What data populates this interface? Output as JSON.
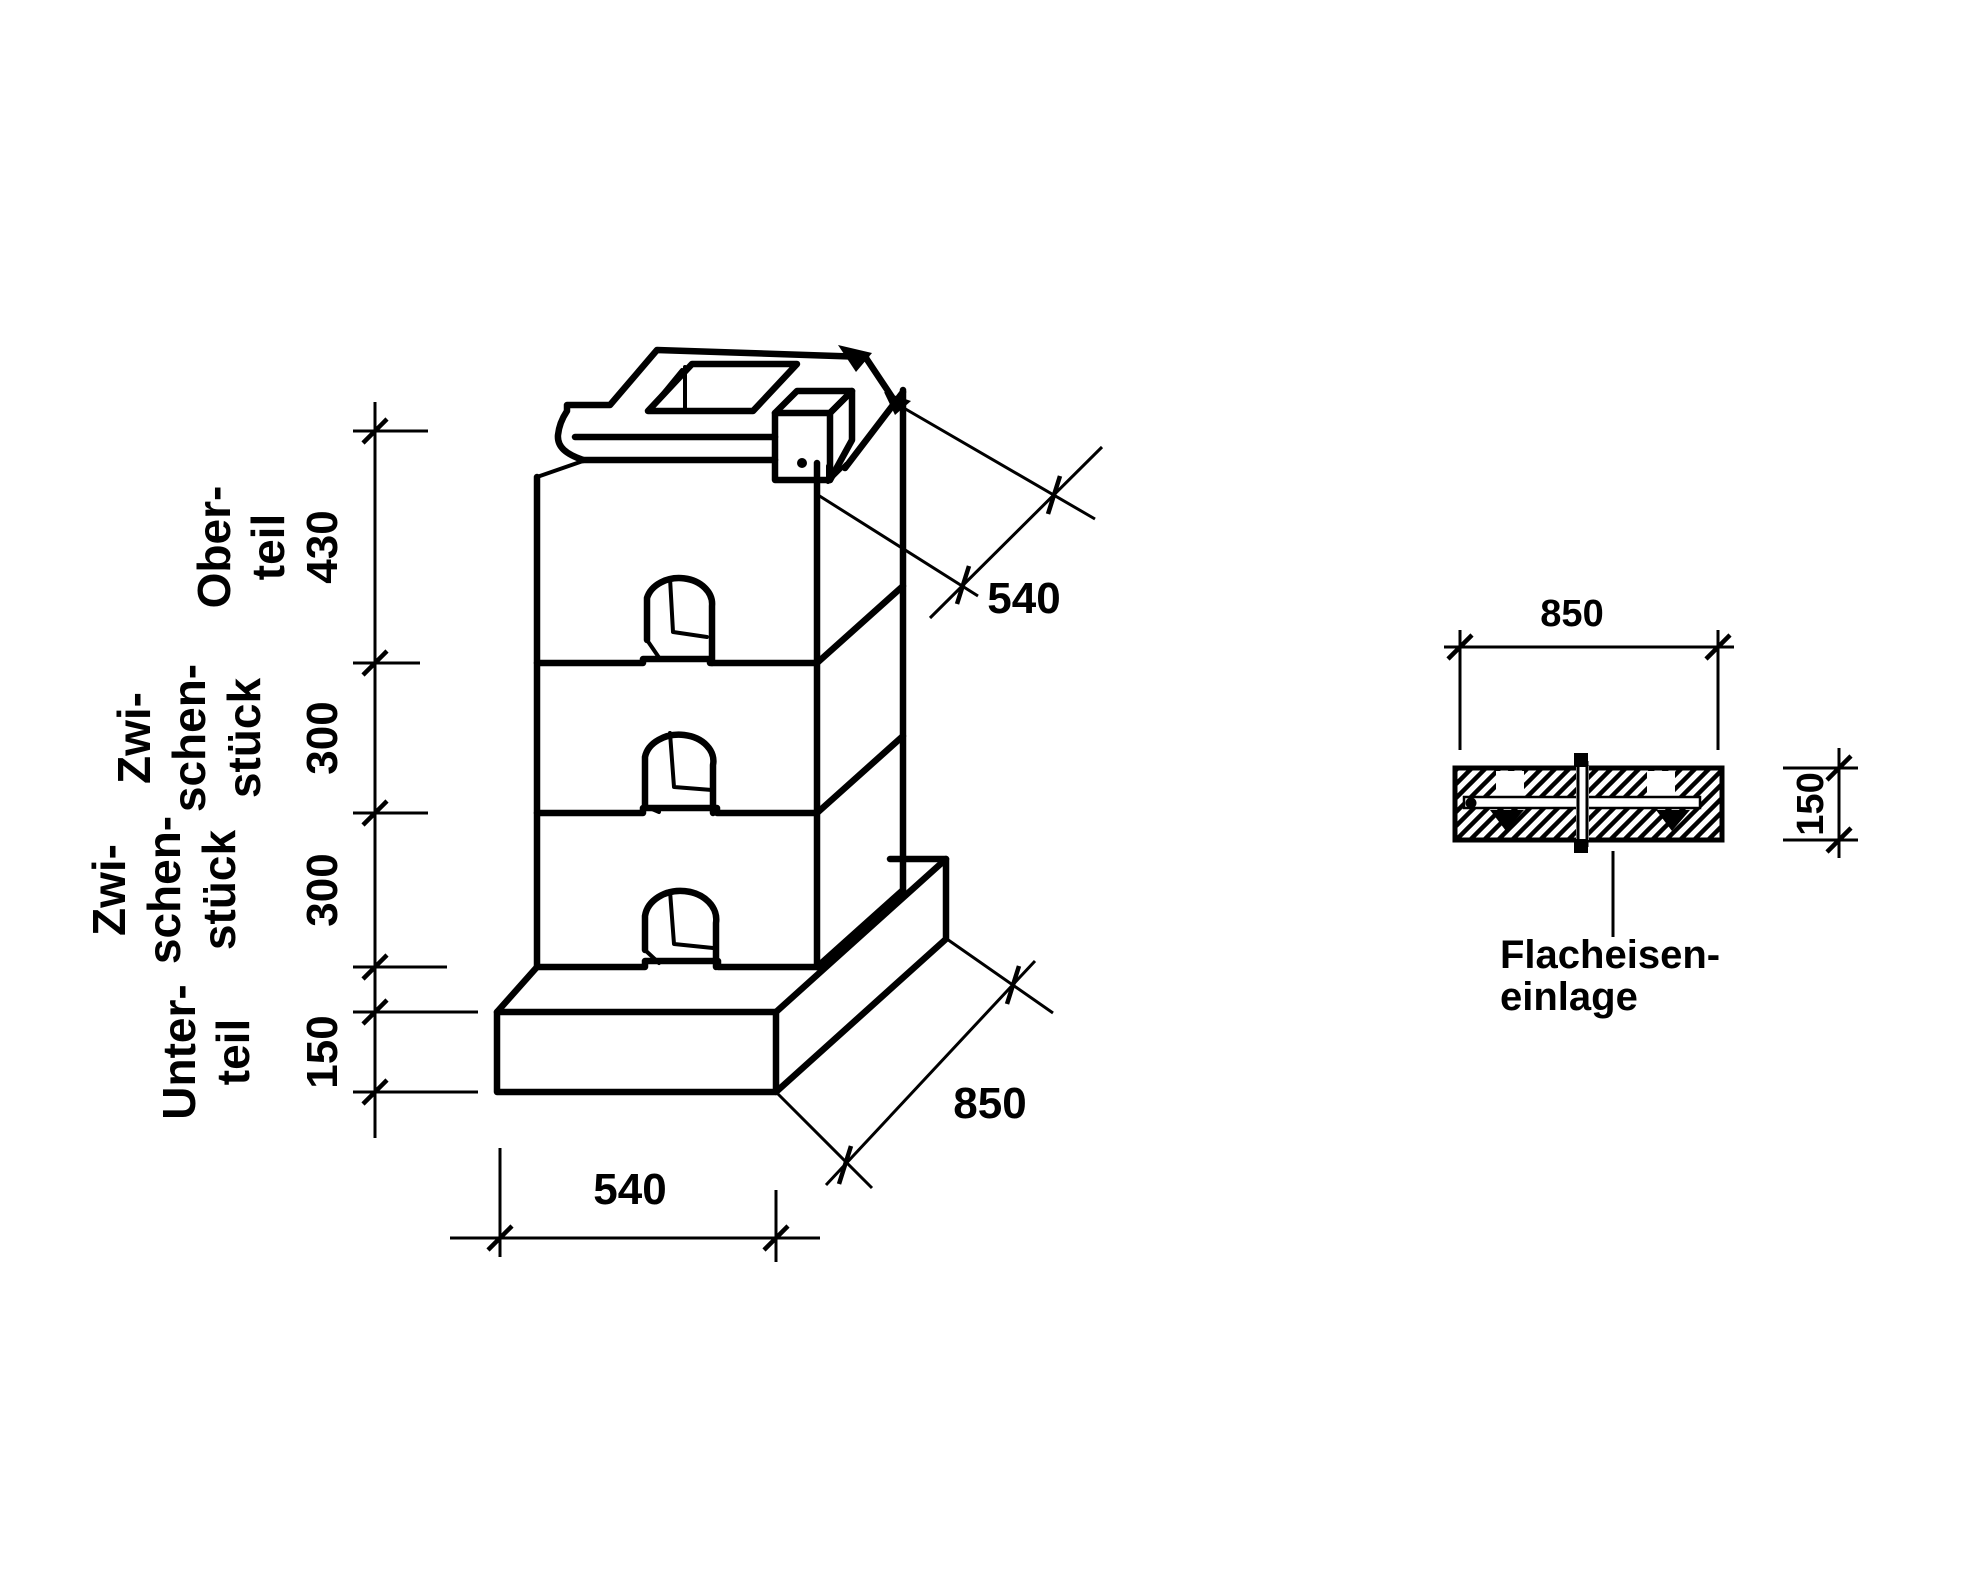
{
  "iso": {
    "part_labels": [
      {
        "lines": [
          "Ober-",
          "teil"
        ],
        "dim": "430"
      },
      {
        "lines": [
          "Zwi-",
          "schen-",
          "stück"
        ],
        "dim": "300"
      },
      {
        "lines": [
          "Zwi-",
          "schen-",
          "stück"
        ],
        "dim": "300"
      },
      {
        "lines": [
          "Unter-",
          "teil"
        ],
        "dim": "150"
      }
    ],
    "top_depth_dim": "540",
    "base_depth_dim": "850",
    "base_width_dim": "540"
  },
  "section": {
    "width_dim": "850",
    "height_dim": "150",
    "label_lines": [
      "Flacheisen-",
      "einlage"
    ]
  },
  "colors": {
    "ink": "#000000",
    "paper": "#ffffff"
  }
}
